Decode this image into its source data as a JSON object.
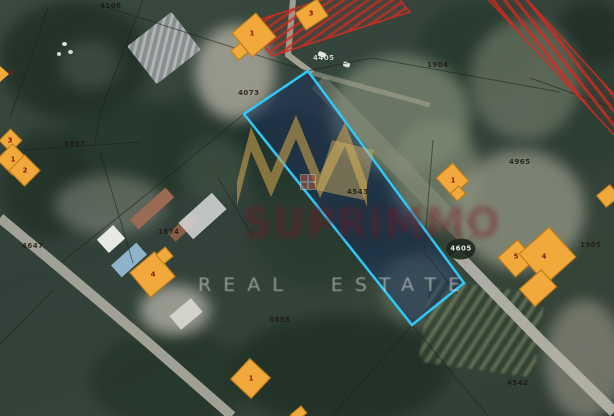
{
  "map": {
    "type": "satellite-cadastre",
    "watermark": {
      "brand": "SUPRIMMO",
      "tagline": "REAL ESTATE"
    },
    "highlighted_parcel": {
      "label": "4543",
      "shape": "long rotated quadrilateral, center of image"
    },
    "building_markers": [
      {
        "num": "1",
        "x": 252,
        "y": 34
      },
      {
        "num": "3",
        "x": 311,
        "y": 14
      },
      {
        "num": "3",
        "x": 10,
        "y": 141
      },
      {
        "num": "1",
        "x": 13,
        "y": 160
      },
      {
        "num": "2",
        "x": 25,
        "y": 171
      },
      {
        "num": "4",
        "x": 153,
        "y": 275
      },
      {
        "num": "1",
        "x": 251,
        "y": 379
      },
      {
        "num": "1",
        "x": 453,
        "y": 181
      },
      {
        "num": "5",
        "x": 516,
        "y": 257
      },
      {
        "num": "4",
        "x": 544,
        "y": 257
      },
      {
        "num": "4",
        "x": 11,
        "y": 73
      }
    ],
    "parcel_labels": [
      {
        "text": "4108",
        "x": 100,
        "y": 3,
        "tone": "dark"
      },
      {
        "text": "4405",
        "x": 313,
        "y": 55,
        "tone": "light"
      },
      {
        "text": "4073",
        "x": 238,
        "y": 90,
        "tone": "dark"
      },
      {
        "text": "1857",
        "x": 64,
        "y": 141,
        "tone": "dark"
      },
      {
        "text": "1874",
        "x": 158,
        "y": 229,
        "tone": "dark"
      },
      {
        "text": "4647",
        "x": 22,
        "y": 243,
        "tone": "dark"
      },
      {
        "text": "4543",
        "x": 347,
        "y": 189,
        "tone": "dark"
      },
      {
        "text": "1904",
        "x": 427,
        "y": 62,
        "tone": "dark"
      },
      {
        "text": "4965",
        "x": 509,
        "y": 159,
        "tone": "dark"
      },
      {
        "text": "1905",
        "x": 580,
        "y": 242,
        "tone": "dark"
      },
      {
        "text": "4605",
        "x": 461,
        "y": 249,
        "tone": "circle"
      },
      {
        "text": "3858",
        "x": 269,
        "y": 317,
        "tone": "dark"
      },
      {
        "text": "4542",
        "x": 507,
        "y": 380,
        "tone": "dark"
      }
    ],
    "restricted_zones": 2
  },
  "colors": {
    "building_fill": "#F2A93B",
    "building_border": "#BA7A14",
    "building_number": "#8A1510",
    "parcel_stroke": "#2EC9F7",
    "parcel_fill": "rgba(22,46,96,0.45)",
    "restricted_hatch": "#D12B20",
    "crown_gold": "#C8A14E"
  }
}
